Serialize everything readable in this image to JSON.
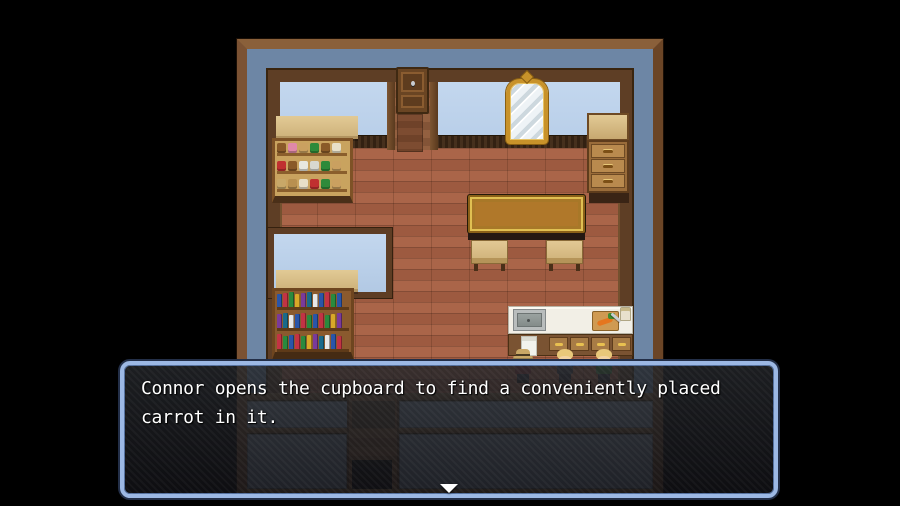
{
  "window": {
    "width": 900,
    "height": 506,
    "app": "rpg-game-screen"
  },
  "dialog": {
    "line1": "Connor opens the cupboard to find a conveniently placed",
    "line2": "carrot in it.",
    "continue_indicator": "down-triangle"
  },
  "theme": {
    "background": "#000000",
    "map_moat_blue": "#6d86a5",
    "wall_blue": "#b9cfe9",
    "floor_red_brown": "#a25f44",
    "counter_tan": "#d9bf8a",
    "table_top": "#b0782a",
    "table_gold_trim": "#e0c052",
    "counter_white": "#f2efe6",
    "carrot_orange": "#e5761e",
    "carrot_green": "#3f8c2e",
    "dialog_border_blue": "#9cb8e4",
    "panel_gray_blue": "#7e90a4",
    "beam_brown": "#7a5332",
    "doorway_black": "#0d0b08"
  },
  "scene": {
    "furniture": [
      "toy-shelf",
      "wall-cupboard",
      "mirror",
      "dresser",
      "long-table",
      "stool",
      "stool",
      "bookshelf",
      "kitchen-counter",
      "sink",
      "cutting-board-with-carrot",
      "jar",
      "towel",
      "south-wall-doorway"
    ],
    "toy_shelf_rows": [
      [
        "#8a5a28",
        "#e088a8",
        "#caa060",
        "#2e8a3a",
        "#8a5a28",
        "#e8e0c8"
      ],
      [
        "#c03030",
        "#8a5a28",
        "#e8e8e0",
        "#d8d8d0",
        "#2e8a3a",
        "#caa060"
      ],
      [
        "#c8a868",
        "#b89050",
        "#e8e0c8",
        "#c03030",
        "#2e8a3a",
        "#caa060"
      ]
    ],
    "book_palette": [
      "#2a55a8",
      "#c23344",
      "#2a8a3e",
      "#d8a828",
      "#7a3a9a",
      "#1a6a8a",
      "#e8e8e8",
      "#2a55a8",
      "#c23344",
      "#2a8a3e"
    ],
    "characters": [
      {
        "id": "villager-with-hat",
        "hat": "#c9a766",
        "hair": null,
        "shirt": "#8a3536",
        "skin": "#f2d3a2"
      },
      {
        "id": "villager-blonde-dark",
        "hat": null,
        "hair": "#e8c87a",
        "shirt": "#45454d",
        "skin": "#f2d3a2"
      },
      {
        "id": "villager-blonde-green",
        "hat": null,
        "hair": "#e8c87a",
        "shirt": "#3f7d3b",
        "skin": "#f2d3a2"
      }
    ]
  }
}
